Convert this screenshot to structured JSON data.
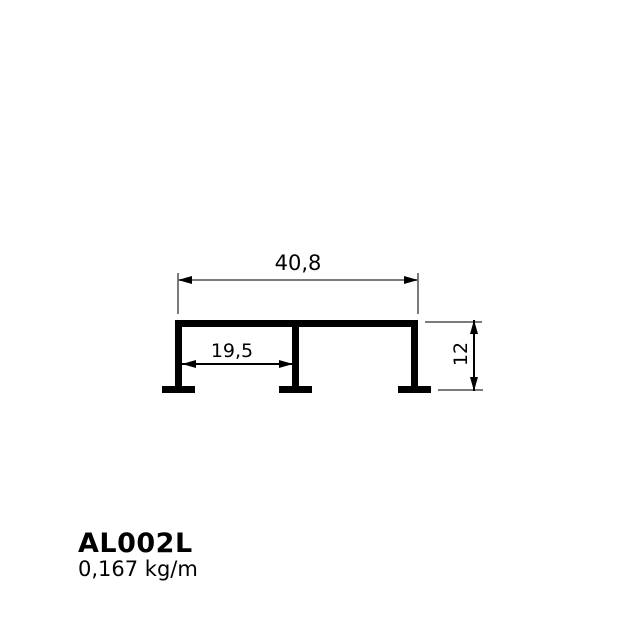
{
  "drawing": {
    "type": "aluminum-profile-cross-section",
    "dimensions": {
      "overall_width": "40,8",
      "inner_span": "19,5",
      "height": "12"
    },
    "profile_code": "AL002L",
    "unit_weight": "0,167 kg/m",
    "colors": {
      "profile": "#000000",
      "dimension_line": "#7b7b7b",
      "arrow": "#000000",
      "text": "#000000",
      "background": "#ffffff"
    }
  }
}
